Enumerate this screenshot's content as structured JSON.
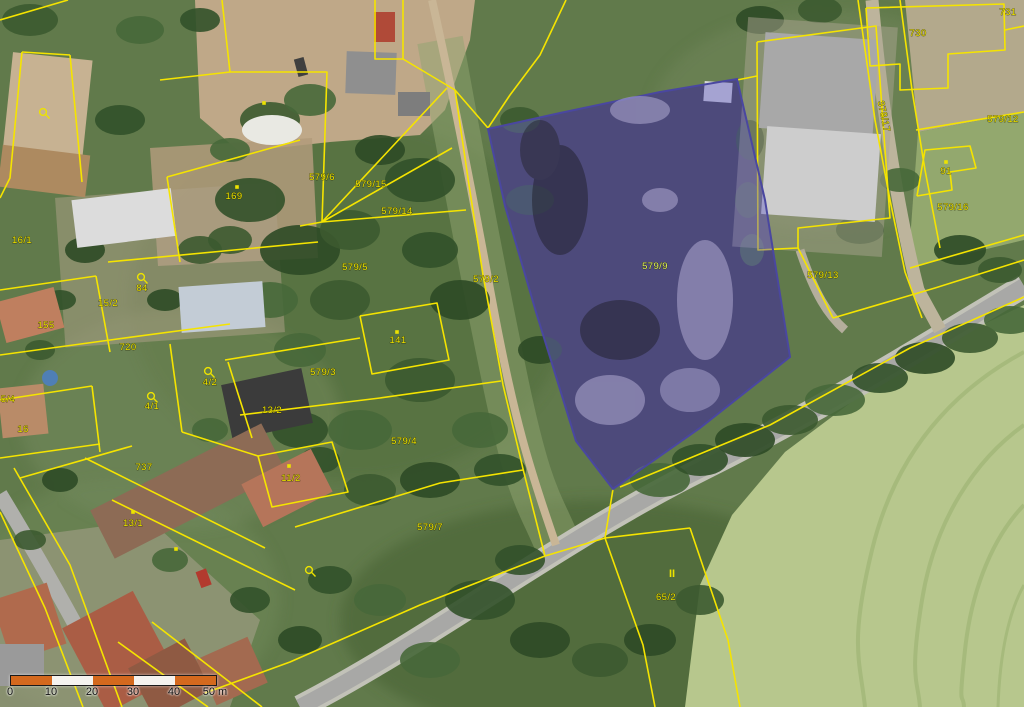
{
  "map": {
    "kind": "cadastral-parcel-map-over-orthophoto",
    "colors": {
      "cadastral_line": "#f5e400",
      "parcel_label": "#ede300",
      "highlight_fill": "#6b66c8",
      "highlight_border": "#4a47a0",
      "scalebar_orange": "#d4691e",
      "scalebar_white": "#f5f3ef"
    },
    "highlighted_parcel": {
      "label": "579/9"
    },
    "parcel_labels": [
      {
        "text": "16/1",
        "x": 22,
        "y": 243
      },
      {
        "text": "84",
        "x": 142,
        "y": 291
      },
      {
        "text": "15/2",
        "x": 108,
        "y": 306
      },
      {
        "text": "155",
        "x": 46,
        "y": 328
      },
      {
        "text": "720",
        "x": 128,
        "y": 350
      },
      {
        "text": "5/4",
        "x": 8,
        "y": 402
      },
      {
        "text": "16",
        "x": 23,
        "y": 432
      },
      {
        "text": "4/2",
        "x": 210,
        "y": 385
      },
      {
        "text": "4/1",
        "x": 152,
        "y": 409
      },
      {
        "text": "13/2",
        "x": 272,
        "y": 413
      },
      {
        "text": "737",
        "x": 144,
        "y": 470
      },
      {
        "text": "11/2",
        "x": 291,
        "y": 481
      },
      {
        "text": "13/1",
        "x": 133,
        "y": 526
      },
      {
        "text": "169",
        "x": 234,
        "y": 199
      },
      {
        "text": "141",
        "x": 398,
        "y": 343
      },
      {
        "text": "579/6",
        "x": 322,
        "y": 180
      },
      {
        "text": "579/15",
        "x": 371,
        "y": 187
      },
      {
        "text": "579/14",
        "x": 397,
        "y": 214
      },
      {
        "text": "579/5",
        "x": 355,
        "y": 270
      },
      {
        "text": "579/2",
        "x": 486,
        "y": 282
      },
      {
        "text": "579/3",
        "x": 323,
        "y": 375
      },
      {
        "text": "579/4",
        "x": 404,
        "y": 444
      },
      {
        "text": "579/7",
        "x": 430,
        "y": 530
      },
      {
        "text": "579/9",
        "x": 655,
        "y": 269,
        "highlight": true
      },
      {
        "text": "579/13",
        "x": 823,
        "y": 278
      },
      {
        "text": "579/12",
        "x": 1003,
        "y": 122
      },
      {
        "text": "91",
        "x": 946,
        "y": 174
      },
      {
        "text": "579/16",
        "x": 953,
        "y": 210
      },
      {
        "text": "730",
        "x": 918,
        "y": 36
      },
      {
        "text": "731",
        "x": 1008,
        "y": 15
      },
      {
        "text": "378/17",
        "x": 881,
        "y": 117,
        "rot": 78
      },
      {
        "text": "65/2",
        "x": 666,
        "y": 600
      }
    ],
    "markers": {
      "landuse_loop": [
        [
          43,
          112
        ],
        [
          141,
          277
        ],
        [
          208,
          371
        ],
        [
          151,
          396
        ],
        [
          309,
          570
        ]
      ],
      "building_dot": [
        [
          264,
          103
        ],
        [
          397,
          332
        ],
        [
          237,
          187
        ],
        [
          946,
          162
        ],
        [
          133,
          512
        ],
        [
          176,
          549
        ],
        [
          289,
          466
        ]
      ],
      "meadow": [
        [
          672,
          577
        ]
      ]
    },
    "scalebar": {
      "tick_labels": [
        "0",
        "10",
        "20",
        "30",
        "40",
        "50 m"
      ],
      "segment_colors": [
        "orange",
        "white",
        "orange",
        "white",
        "orange"
      ]
    }
  }
}
